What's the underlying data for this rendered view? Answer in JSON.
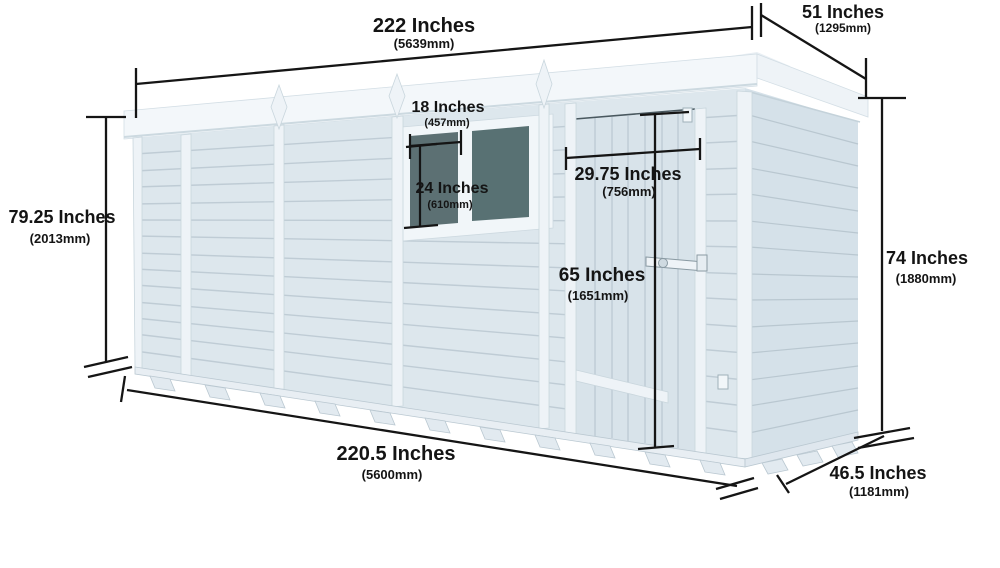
{
  "diagram": {
    "dimensions": {
      "overall_width": {
        "label": "222 Inches",
        "metric": "(5639mm)"
      },
      "roof_depth": {
        "label": "51 Inches",
        "metric": "(1295mm)"
      },
      "front_height": {
        "label": "79.25 Inches",
        "metric": "(2013mm)"
      },
      "rear_height": {
        "label": "74 Inches",
        "metric": "(1880mm)"
      },
      "window_width": {
        "label": "18 Inches",
        "metric": "(457mm)"
      },
      "window_height": {
        "label": "24 Inches",
        "metric": "(610mm)"
      },
      "door_width": {
        "label": "29.75 Inches",
        "metric": "(756mm)"
      },
      "door_height": {
        "label": "65 Inches",
        "metric": "(1651mm)"
      },
      "base_width": {
        "label": "220.5 Inches",
        "metric": "(5600mm)"
      },
      "base_depth": {
        "label": "46.5 Inches",
        "metric": "(1181mm)"
      }
    },
    "colors": {
      "background": "#ffffff",
      "wall": "#dde7ed",
      "end_wall": "#d5e1e9",
      "door": "#d8e3ea",
      "trim": "#eef3f7",
      "roof": "#f3f7fa",
      "glass": "#5c7073",
      "dimension_lines": "#151515"
    }
  }
}
